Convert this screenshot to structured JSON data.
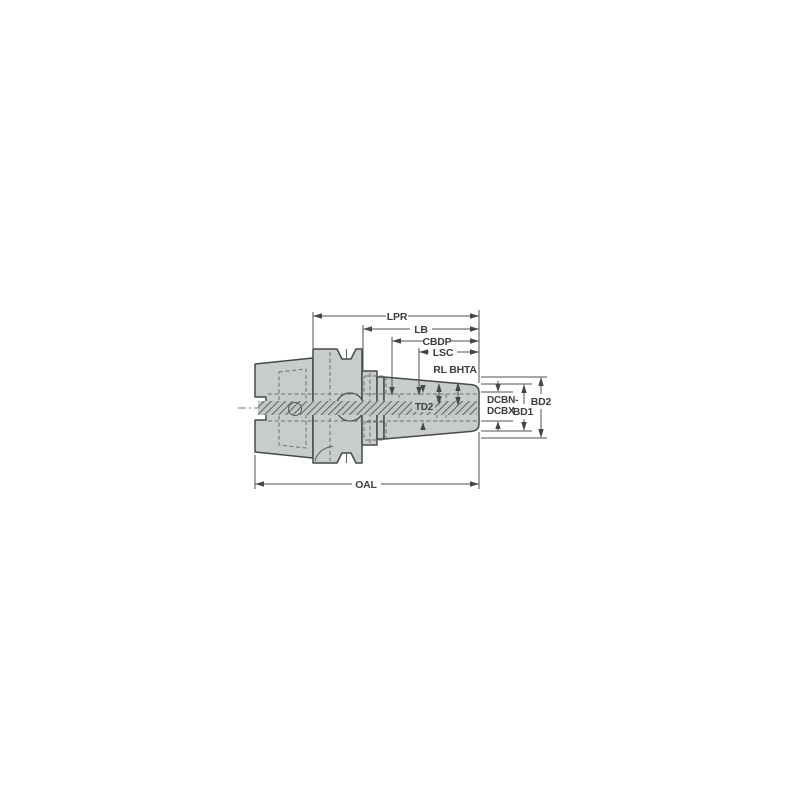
{
  "diagram": {
    "type": "technical-dimension-drawing",
    "subject": "shrink-fit tool holder with hollow taper shank, side view with dimension callouts",
    "labels": {
      "lpr": "LPR",
      "lb": "LB",
      "cbdp": "CBDP",
      "lsc": "LSC",
      "rl": "RL",
      "bhta": "BHTA",
      "td2": "TD2",
      "dcbn": "DCBN-",
      "dcbx": "DCBX",
      "bd1": "BD1",
      "bd2": "BD2",
      "oal": "OAL"
    },
    "colors": {
      "background": "#ffffff",
      "body_fill": "#c9cdca",
      "outline": "#454b49",
      "dimension_line": "#4d5351",
      "label_text": "#3b403e"
    }
  }
}
